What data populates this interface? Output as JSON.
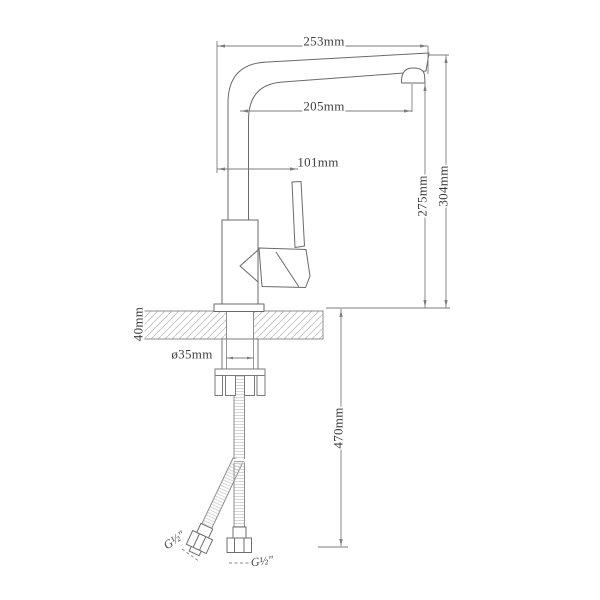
{
  "diagram": {
    "labels": {
      "spout_top_width": "253mm",
      "spout_reach": "205mm",
      "handle_offset": "101mm",
      "outlet_height": "275mm",
      "overall_height": "304mm",
      "deck_thickness": "40mm",
      "mount_hole_diameter": "ø35mm",
      "hose_length": "470mm",
      "side_hose_thread": "G½″",
      "bottom_hose_thread": "G½″"
    },
    "colors": {
      "background": "#ffffff",
      "outline": "#6a6a6a",
      "dimension_line": "#7d7d7d",
      "hatch": "#bdbdbd",
      "text": "#3d3d3d"
    }
  }
}
